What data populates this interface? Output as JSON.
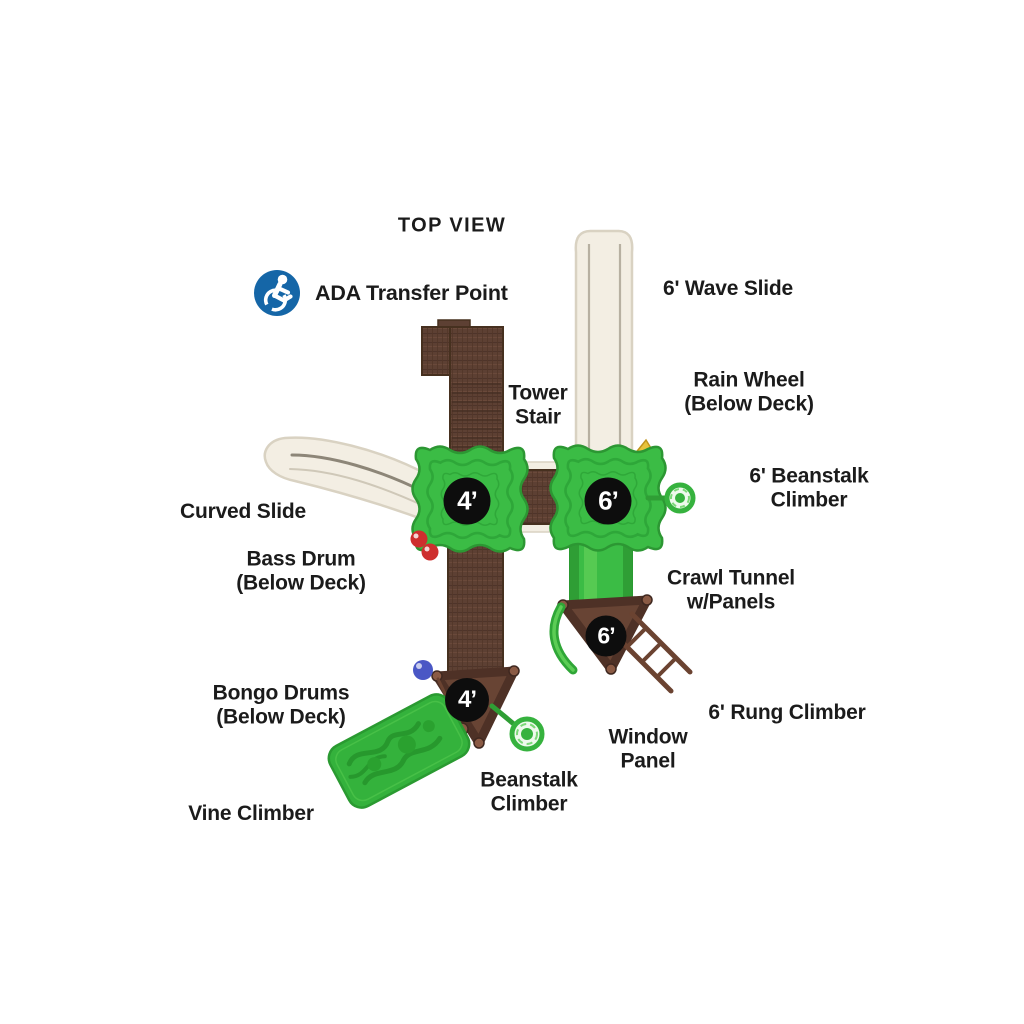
{
  "title": "TOP VIEW",
  "ada_transfer_point": "ADA Transfer Point",
  "deck_badges": {
    "main_4ft": "4’",
    "main_6ft": "6’",
    "lower_6ft": "6’",
    "lower_4ft": "4’"
  },
  "labels": {
    "wave_slide": "6' Wave Slide",
    "tower_stair_line1": "Tower",
    "tower_stair_line2": "Stair",
    "rain_wheel_line1": "Rain Wheel",
    "rain_wheel_line2": "(Below Deck)",
    "beanstalk_6ft_line1": "6' Beanstalk",
    "beanstalk_6ft_line2": "Climber",
    "curved_slide": "Curved Slide",
    "bass_drum_line1": "Bass Drum",
    "bass_drum_line2": "(Below Deck)",
    "crawl_tunnel_line1": "Crawl Tunnel",
    "crawl_tunnel_line2": "w/Panels",
    "bongo_drums_line1": "Bongo Drums",
    "bongo_drums_line2": "(Below Deck)",
    "rung_climber": "6' Rung Climber",
    "window_panel_line1": "Window",
    "window_panel_line2": "Panel",
    "beanstalk_line1": "Beanstalk",
    "beanstalk_line2": "Climber",
    "vine_climber": "Vine Climber"
  },
  "colors": {
    "deck_green": "#3bbc45",
    "deck_green_dark": "#2c9733",
    "vine_green": "#34b23c",
    "walkway_brown": "#5d4033",
    "walkway_brown_dark": "#46301f",
    "triangle_brown": "#684434",
    "ladder_brown": "#6b4331",
    "slide_cream": "#f3eee3",
    "slide_cream_border": "#d9d2c2",
    "badge_black": "#0d0d0d",
    "text_black": "#1b1b1b",
    "ada_blue": "#1566a7",
    "bass_drum_red": "#ce2f2e",
    "bongo_blue": "#4a57c5",
    "flag_yellow": "#e7c33c"
  }
}
